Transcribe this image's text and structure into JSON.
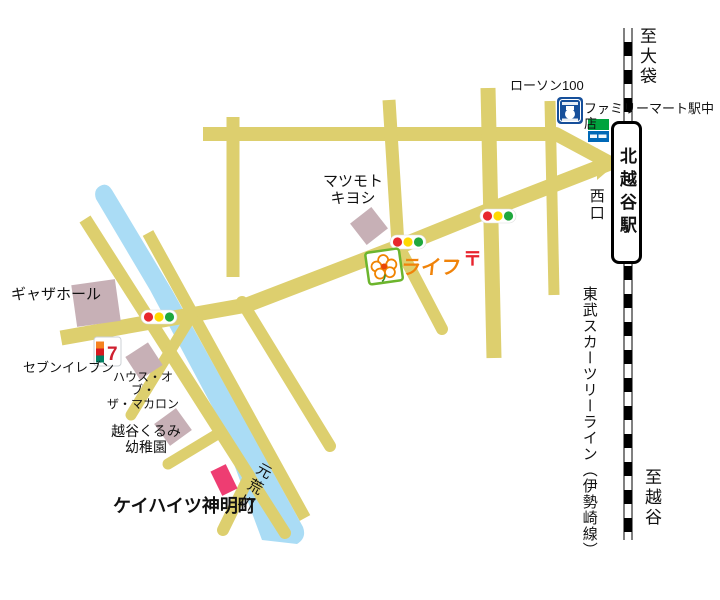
{
  "map": {
    "labels": {
      "to_obukuro": "至大袋",
      "to_koshigaya": "至越谷",
      "station": "北越谷駅",
      "west_exit": "西口",
      "railway_line": "東武スカーツリーライン（伊勢崎線）",
      "familymart": "ファミリーマート駅中店",
      "lawson": "ローソン100",
      "matsumoto": "マツモト\nキヨシ",
      "life": "ライフ",
      "postal_mark": "〒",
      "gather_hall": "ギャザホール",
      "seven_eleven": "セブンイレブン",
      "macaron": "ハウス・オブ・\nザ・マカロン",
      "kindergarten": "越谷くるみ\n幼稚園",
      "destination": "ケイハイツ神明町",
      "river": "元荒川",
      "seven_logo_text": "7"
    },
    "colors": {
      "road": "#ddcf6e",
      "river": "#aadcf5",
      "building": "#c7b0b6",
      "destination_building": "#ee3d72",
      "railway": "#000000",
      "signal_red": "#e8272d",
      "signal_yellow": "#ffd900",
      "signal_green": "#1fa83d",
      "life_orange": "#f0830a",
      "life_green": "#6cb52d",
      "lawson_blue": "#164f9a",
      "familymart_green": "#00a33e",
      "familymart_blue": "#0068b7",
      "seven_orange": "#f58220",
      "seven_red": "#d71920",
      "seven_green": "#008063",
      "postal_red": "#e8232d"
    }
  }
}
